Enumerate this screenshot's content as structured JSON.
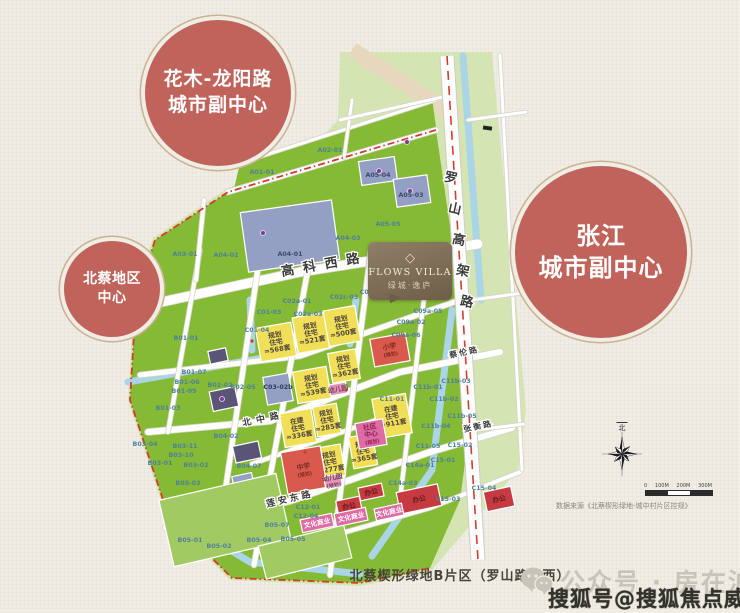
{
  "bubbles": [
    {
      "name": "huamu-longyang-subcenter",
      "lines": [
        "花木-龙阳路",
        "城市副中心"
      ]
    },
    {
      "name": "zhangjiang-subcenter",
      "lines": [
        "张江",
        "城市副中心"
      ]
    },
    {
      "name": "beicai-district-center",
      "lines": [
        "北蔡地区",
        "中心"
      ]
    }
  ],
  "logo": {
    "title": "FLOWS VILLA",
    "subtitle": "绿城·逸庐",
    "diamond": "◇"
  },
  "caption": "北蔡楔形绿地B片区（罗山路以西）",
  "source_note": "数据来源《北蔡楔形绿地-城中村片区控规》",
  "compass_north": "北",
  "scalebar_labels": [
    "0",
    "100M",
    "200M",
    "300M"
  ],
  "watermarks": {
    "wechat": "公众号 · 房在沪上",
    "sohu": "搜狐号@搜狐焦点威安站"
  },
  "colors": {
    "paper": "#f0ede5",
    "pale_green": "#d5e4b3",
    "green": "#84ba34",
    "light_green": "#a2ca62",
    "yellow": "#f2df58",
    "red": "#d95a4c",
    "office_red": "#c63a42",
    "pink": "#de6ba3",
    "light_pink": "#e891ba",
    "blue_gray": "#93a0c4",
    "dark_slate": "#5a5476",
    "water": "#a9d5e6",
    "road": "#ffffff",
    "boundary_red": "#d43b2c",
    "circle_red": "#c0635a",
    "rail_band": "#e7d8bd"
  },
  "map": {
    "road_labels": [
      {
        "t": "高科西路",
        "x": 282,
        "y": 276,
        "r": -10,
        "fs": 13,
        "ls": 9
      },
      {
        "t": "北中路",
        "x": 243,
        "y": 426,
        "r": -12,
        "fs": 9,
        "ls": 5
      },
      {
        "t": "莲安东路",
        "x": 267,
        "y": 507,
        "r": -13,
        "fs": 9,
        "ls": 3
      },
      {
        "t": "蔡伦路",
        "x": 450,
        "y": 358,
        "r": -12,
        "fs": 8,
        "ls": 2
      },
      {
        "t": "张衡路",
        "x": 464,
        "y": 432,
        "r": -12,
        "fs": 8,
        "ls": 2
      }
    ],
    "elevated_label": {
      "chars": [
        "罗",
        "山",
        "高",
        "架",
        "路"
      ],
      "x": 450,
      "y": 182,
      "dx": 4,
      "dy": 31,
      "rot": 12,
      "fs": 13
    },
    "parcels": [
      {
        "x": 290,
        "y": 236,
        "w": 92,
        "h": 60,
        "f": "b",
        "r": -8
      },
      {
        "x": 378,
        "y": 171,
        "w": 36,
        "h": 24,
        "f": "b",
        "r": -8
      },
      {
        "x": 412,
        "y": 191,
        "w": 34,
        "h": 28,
        "f": "b",
        "r": -8
      },
      {
        "x": 278,
        "y": 389,
        "w": 26,
        "h": 28,
        "f": "b",
        "r": -10
      },
      {
        "x": 243,
        "y": 481,
        "w": 20,
        "h": 13,
        "f": "b",
        "r": -12
      },
      {
        "x": 224,
        "y": 399,
        "w": 26,
        "h": 20,
        "f": "d",
        "r": -12
      },
      {
        "x": 247,
        "y": 452,
        "w": 26,
        "h": 17,
        "f": "d",
        "r": -12
      },
      {
        "x": 218,
        "y": 356,
        "w": 18,
        "h": 13,
        "f": "d",
        "r": -12
      },
      {
        "x": 225,
        "y": 520,
        "w": 120,
        "h": 68,
        "f": "lg",
        "r": -13
      },
      {
        "x": 305,
        "y": 552,
        "w": 88,
        "h": 34,
        "f": "lg",
        "r": -14
      },
      {
        "x": 276,
        "y": 342,
        "w": 36,
        "h": 34,
        "f": "y",
        "l": [
          "规划",
          "住宅",
          "≈568套"
        ]
      },
      {
        "x": 311,
        "y": 333,
        "w": 32,
        "h": 36,
        "f": "y",
        "l": [
          "规划",
          "住宅",
          "≈521套"
        ]
      },
      {
        "x": 342,
        "y": 326,
        "w": 32,
        "h": 36,
        "f": "y",
        "l": [
          "规划",
          "住宅",
          "≈500套"
        ]
      },
      {
        "x": 312,
        "y": 385,
        "w": 34,
        "h": 32,
        "f": "y",
        "l": [
          "规划",
          "住宅",
          "≈539套"
        ]
      },
      {
        "x": 344,
        "y": 366,
        "w": 28,
        "h": 30,
        "f": "y",
        "l": [
          "规划",
          "住宅",
          "≈362套"
        ]
      },
      {
        "x": 298,
        "y": 428,
        "w": 32,
        "h": 34,
        "f": "y",
        "l": [
          "在建",
          "住宅",
          "≈336套"
        ]
      },
      {
        "x": 327,
        "y": 420,
        "w": 24,
        "h": 30,
        "f": "y",
        "l": [
          "规划",
          "住宅",
          "≈285套"
        ]
      },
      {
        "x": 392,
        "y": 416,
        "w": 34,
        "h": 40,
        "f": "y",
        "l": [
          "在建",
          "住宅",
          "≈911套"
        ]
      },
      {
        "x": 330,
        "y": 462,
        "w": 26,
        "h": 32,
        "f": "y",
        "l": [
          "规划",
          "住宅",
          "≈277套"
        ]
      },
      {
        "x": 363,
        "y": 451,
        "w": 24,
        "h": 32,
        "f": "y",
        "l": [
          "规划",
          "住宅",
          "≈365套"
        ]
      },
      {
        "x": 390,
        "y": 350,
        "w": 36,
        "h": 28,
        "f": "r",
        "l": [
          "小学",
          "(规划)"
        ]
      },
      {
        "x": 304,
        "y": 470,
        "w": 40,
        "h": 42,
        "f": "r",
        "l": [
          "中学",
          "(规划)"
        ]
      },
      {
        "x": 371,
        "y": 434,
        "w": 28,
        "h": 26,
        "f": "p",
        "tc": "#8c2450",
        "l": [
          "社区",
          "中心",
          "(规划)"
        ]
      },
      {
        "x": 338,
        "y": 389,
        "w": 17,
        "h": 11,
        "f": "pp",
        "l": [
          "幼儿园"
        ]
      },
      {
        "x": 333,
        "y": 481,
        "w": 17,
        "h": 12,
        "f": "pp",
        "l": [
          "幼儿园",
          "(规划)"
        ]
      },
      {
        "x": 349,
        "y": 506,
        "w": 24,
        "h": 15,
        "f": "rr",
        "r": -12,
        "l": [
          "办公"
        ]
      },
      {
        "x": 371,
        "y": 492,
        "w": 24,
        "h": 13,
        "f": "rr",
        "r": -12,
        "l": [
          "办公"
        ]
      },
      {
        "x": 419,
        "y": 499,
        "w": 42,
        "h": 22,
        "f": "rr",
        "r": -12,
        "l": [
          "办公"
        ]
      },
      {
        "x": 499,
        "y": 499,
        "w": 28,
        "h": 20,
        "f": "rr",
        "r": -12,
        "l": [
          "办公"
        ]
      },
      {
        "x": 317,
        "y": 523,
        "w": 32,
        "h": 13,
        "f": "p",
        "r": -12,
        "l": [
          "文化商业"
        ]
      },
      {
        "x": 351,
        "y": 517,
        "w": 32,
        "h": 13,
        "f": "p",
        "r": -12,
        "l": [
          "文化商业"
        ]
      },
      {
        "x": 389,
        "y": 512,
        "w": 28,
        "h": 12,
        "f": "p",
        "r": -12,
        "l": [
          "文化商业"
        ]
      }
    ],
    "codes": [
      [
        "A01-01",
        262,
        174
      ],
      [
        "A02-01",
        330,
        152
      ],
      [
        "A03-01",
        185,
        256
      ],
      [
        "A04-02",
        226,
        257
      ],
      [
        "A04-01",
        290,
        256,
        "#3f4868"
      ],
      [
        "A04-03",
        348,
        240
      ],
      [
        "A05-04",
        378,
        177,
        "#3f4868"
      ],
      [
        "A05-03",
        411,
        197,
        "#3f4868"
      ],
      [
        "A05-05",
        388,
        226
      ],
      [
        "B01-01",
        186,
        340
      ],
      [
        "B01-07",
        194,
        374
      ],
      [
        "B01-06",
        187,
        384
      ],
      [
        "B01-05",
        184,
        393
      ],
      [
        "B01-03",
        168,
        410
      ],
      [
        "B02-02",
        220,
        387
      ],
      [
        "B02-05",
        243,
        389
      ],
      [
        "B03-04",
        145,
        446
      ],
      [
        "B03-11",
        185,
        448
      ],
      [
        "B03-10",
        181,
        457
      ],
      [
        "B03-01",
        160,
        465
      ],
      [
        "B03-02",
        196,
        467
      ],
      [
        "B04-02",
        226,
        438
      ],
      [
        "B04-07",
        249,
        468
      ],
      [
        "B05-03",
        188,
        485
      ],
      [
        "B05-01",
        190,
        542
      ],
      [
        "B05-02",
        219,
        548
      ],
      [
        "B05-04",
        259,
        542
      ],
      [
        "B05-07",
        277,
        527
      ],
      [
        "B05-05",
        293,
        541
      ],
      [
        "C01-03",
        269,
        314
      ],
      [
        "C01-04",
        257,
        332
      ],
      [
        "C02a-01",
        297,
        303
      ],
      [
        "C02a-03",
        308,
        316
      ],
      [
        "C02c-03",
        344,
        299
      ],
      [
        "C02c-04",
        374,
        294
      ],
      [
        "C09a-05",
        428,
        313
      ],
      [
        "C09a-02",
        411,
        324
      ],
      [
        "C09a-06",
        406,
        337
      ],
      [
        "C03-02b",
        278,
        389,
        "#2e3a5c"
      ],
      [
        "C11-01",
        392,
        401
      ],
      [
        "C11-05",
        428,
        448
      ],
      [
        "C11b-01",
        428,
        389
      ],
      [
        "C11b-02",
        444,
        401
      ],
      [
        "C11b-03",
        456,
        383
      ],
      [
        "C11b-04",
        436,
        428
      ],
      [
        "C11b-05",
        462,
        418
      ],
      [
        "C12-01",
        308,
        509
      ],
      [
        "C12-04",
        306,
        518
      ],
      [
        "C14a-01",
        420,
        467
      ],
      [
        "C14a-03",
        403,
        485
      ],
      [
        "C15-01",
        443,
        462
      ],
      [
        "C15-02",
        460,
        447
      ],
      [
        "C15-03",
        448,
        501
      ],
      [
        "C15-04",
        484,
        490
      ]
    ]
  }
}
